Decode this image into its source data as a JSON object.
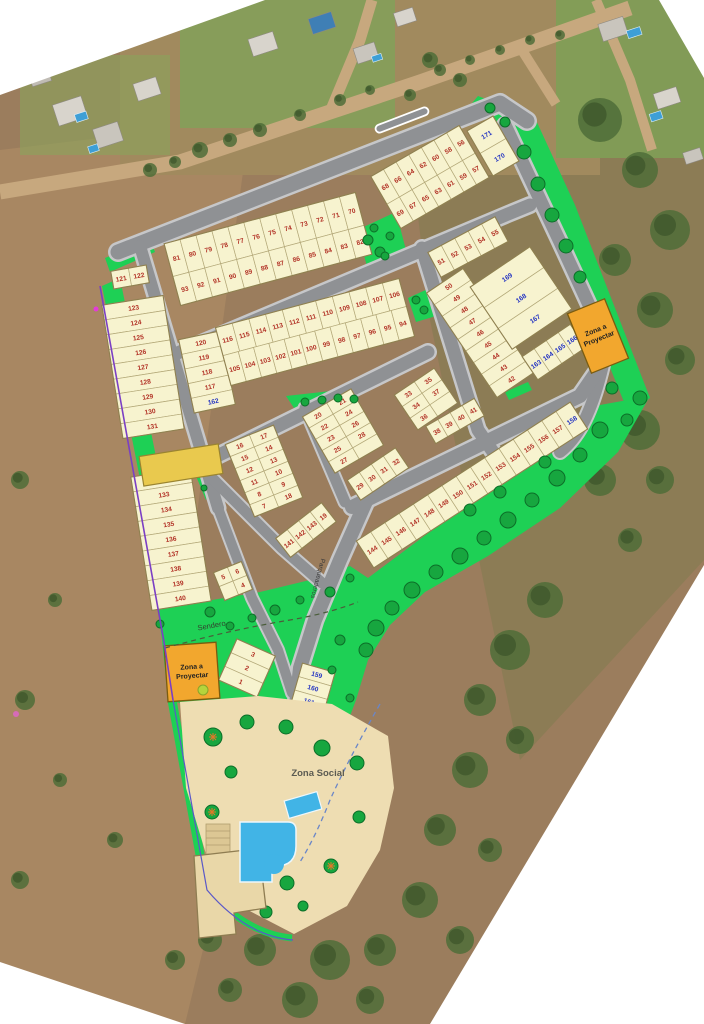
{
  "map": {
    "labels": {
      "zona_a_line1": "Zona a",
      "zona_a_line2": "Proyectar",
      "zona_social": "Zona Social",
      "sendero": "Sendero",
      "parqueaderos": "Parqueaderos"
    },
    "colors": {
      "lot_fill": "#f7f3cf",
      "lot_line": "#b3a878",
      "lot_border": "#8f8050",
      "lot_number_red": "#b23226",
      "lot_number_blue": "#2434c2",
      "road": "#8f9194",
      "curb": "#c6c7c9",
      "green": "#1ed055",
      "tree": "#17a63f",
      "tree_dark": "#0c6e28",
      "orange_zone": "#f2a72e",
      "yellow_zone": "#e9c94e",
      "social_tan": "#eeddb2",
      "pool_blue": "#41b4e6",
      "boundary_purple": "#7b3fc4"
    },
    "blue_lots": [
      158,
      159,
      160,
      161,
      162,
      163,
      164,
      165,
      166,
      167,
      168,
      169,
      170,
      171
    ],
    "strips": [
      {
        "id": "band1",
        "cx": 268,
        "cy": 249,
        "angle": -15,
        "len": 198,
        "rows": [
          {
            "h": 34,
            "nums": [
              81,
              80,
              79,
              78,
              77,
              76,
              75,
              74,
              73,
              72,
              71,
              70
            ]
          },
          {
            "h": 30,
            "nums": [
              93,
              92,
              91,
              90,
              89,
              88,
              87,
              86,
              85,
              84,
              83,
              82
            ]
          }
        ]
      },
      {
        "id": "band1b",
        "cx": 430,
        "cy": 177,
        "angle": -30,
        "len": 102,
        "rows": [
          {
            "h": 32,
            "nums": [
              68,
              66,
              64,
              62,
              60,
              58,
              56
            ]
          },
          {
            "h": 28,
            "nums": [
              69,
              67,
              65,
              63,
              61,
              59,
              57
            ]
          }
        ]
      },
      {
        "id": "end-170",
        "cx": 493,
        "cy": 146,
        "angle": -30,
        "len": 30,
        "rows": [
          {
            "h": 26,
            "nums": [
              171
            ]
          },
          {
            "h": 26,
            "nums": [
              170
            ]
          }
        ]
      },
      {
        "id": "col-117",
        "cx": 207,
        "cy": 372,
        "angle": -12,
        "len": 42,
        "rows": [
          {
            "h": 15,
            "nums": [
              120
            ]
          },
          {
            "h": 15,
            "nums": [
              119
            ]
          },
          {
            "h": 15,
            "nums": [
              118
            ]
          },
          {
            "h": 15,
            "nums": [
              117
            ]
          },
          {
            "h": 15,
            "nums": [
              162
            ]
          }
        ]
      },
      {
        "id": "band2",
        "cx": 315,
        "cy": 332,
        "angle": -15,
        "len": 190,
        "rows": [
          {
            "h": 29,
            "nums": [
              116,
              115,
              114,
              113,
              112,
              111,
              110,
              109,
              108,
              107,
              106
            ]
          },
          {
            "h": 31,
            "nums": [
              105,
              104,
              103,
              102,
              101,
              100,
              99,
              98,
              97,
              96,
              95,
              94
            ]
          }
        ]
      },
      {
        "id": "col-42-50",
        "cx": 480,
        "cy": 333,
        "angle": -34,
        "len": 44,
        "rows": [
          {
            "h": 14,
            "nums": [
              50
            ]
          },
          {
            "h": 14,
            "nums": [
              49
            ]
          },
          {
            "h": 14,
            "nums": [
              48
            ]
          },
          {
            "h": 14,
            "nums": [
              47
            ]
          },
          {
            "h": 14,
            "nums": [
              46
            ]
          },
          {
            "h": 14,
            "nums": [
              45
            ]
          },
          {
            "h": 14,
            "nums": [
              44
            ]
          },
          {
            "h": 14,
            "nums": [
              43
            ]
          },
          {
            "h": 14,
            "nums": [
              42
            ]
          }
        ]
      },
      {
        "id": "big-167",
        "cx": 521,
        "cy": 298,
        "angle": -34,
        "len": 72,
        "rows": [
          {
            "h": 25,
            "nums": [
              169
            ]
          },
          {
            "h": 25,
            "nums": [
              168
            ]
          },
          {
            "h": 25,
            "nums": [
              167
            ]
          }
        ]
      },
      {
        "id": "row-163",
        "cx": 554,
        "cy": 352,
        "angle": -34,
        "len": 58,
        "rows": [
          {
            "h": 28,
            "nums": [
              163,
              164,
              165,
              166
            ]
          }
        ]
      },
      {
        "id": "blk-33",
        "cx": 426,
        "cy": 399,
        "angle": -34,
        "len": 48,
        "rows": [
          {
            "h": 14,
            "nums": [
              33,
              35
            ]
          },
          {
            "h": 14,
            "nums": [
              34,
              37
            ]
          },
          {
            "h": 14,
            "nums": [
              36,
              null
            ]
          }
        ]
      },
      {
        "id": "blk-38",
        "cx": 455,
        "cy": 421,
        "angle": -30,
        "len": 56,
        "rows": [
          {
            "h": 20,
            "nums": [
              38,
              39,
              40,
              41
            ]
          }
        ]
      },
      {
        "id": "blk-7-18",
        "cx": 264,
        "cy": 471,
        "angle": -22,
        "len": 52,
        "rows": [
          {
            "h": 13,
            "nums": [
              16,
              17
            ]
          },
          {
            "h": 13,
            "nums": [
              15,
              14
            ]
          },
          {
            "h": 13,
            "nums": [
              12,
              13
            ]
          },
          {
            "h": 13,
            "nums": [
              11,
              10
            ]
          },
          {
            "h": 13,
            "nums": [
              8,
              9
            ]
          },
          {
            "h": 13,
            "nums": [
              7,
              18
            ]
          }
        ]
      },
      {
        "id": "blk-141",
        "cx": 306,
        "cy": 530,
        "angle": -38,
        "len": 58,
        "rows": [
          {
            "h": 24,
            "nums": [
              141,
              142,
              143,
              19
            ]
          }
        ]
      },
      {
        "id": "blk-20-28",
        "cx": 343,
        "cy": 431,
        "angle": -30,
        "len": 56,
        "rows": [
          {
            "h": 13,
            "nums": [
              20,
              21
            ]
          },
          {
            "h": 13,
            "nums": [
              22,
              24
            ]
          },
          {
            "h": 13,
            "nums": [
              23,
              26
            ]
          },
          {
            "h": 13,
            "nums": [
              25,
              28
            ]
          },
          {
            "h": 13,
            "nums": [
              27,
              null
            ]
          }
        ]
      },
      {
        "id": "blk-29-32",
        "cx": 378,
        "cy": 474,
        "angle": -34,
        "len": 58,
        "rows": [
          {
            "h": 24,
            "nums": [
              29,
              30,
              31,
              32
            ]
          }
        ]
      },
      {
        "id": "strip-144-158",
        "cx": 472,
        "cy": 485,
        "angle": -33,
        "len": 255,
        "rows": [
          {
            "h": 32,
            "nums": [
              144,
              145,
              146,
              147,
              148,
              149,
              150,
              151,
              152,
              153,
              154,
              155,
              156,
              157,
              158
            ]
          }
        ]
      },
      {
        "id": "col-121",
        "cx": 130,
        "cy": 277,
        "angle": -10,
        "len": 36,
        "rows": [
          {
            "h": 18,
            "nums": [
              121,
              122
            ]
          }
        ]
      },
      {
        "id": "col-123-131",
        "cx": 143,
        "cy": 367,
        "angle": -9,
        "len": 62,
        "rows": [
          {
            "h": 15,
            "nums": [
              123
            ]
          },
          {
            "h": 15,
            "nums": [
              124
            ]
          },
          {
            "h": 15,
            "nums": [
              125
            ]
          },
          {
            "h": 15,
            "nums": [
              126
            ]
          },
          {
            "h": 15,
            "nums": [
              127
            ]
          },
          {
            "h": 15,
            "nums": [
              128
            ]
          },
          {
            "h": 15,
            "nums": [
              129
            ]
          },
          {
            "h": 15,
            "nums": [
              130
            ]
          },
          {
            "h": 15,
            "nums": [
              131
            ]
          }
        ]
      },
      {
        "id": "col-132-140",
        "cx": 171,
        "cy": 539,
        "angle": -9,
        "len": 60,
        "rows": [
          {
            "h": 15,
            "nums": [
              132
            ]
          },
          {
            "h": 15,
            "nums": [
              133
            ]
          },
          {
            "h": 15,
            "nums": [
              134
            ]
          },
          {
            "h": 15,
            "nums": [
              135
            ]
          },
          {
            "h": 15,
            "nums": [
              136
            ]
          },
          {
            "h": 15,
            "nums": [
              137
            ]
          },
          {
            "h": 15,
            "nums": [
              138
            ]
          },
          {
            "h": 15,
            "nums": [
              139
            ]
          },
          {
            "h": 15,
            "nums": [
              140
            ]
          }
        ]
      },
      {
        "id": "blk-4-6",
        "cx": 233,
        "cy": 581,
        "angle": -22,
        "len": 30,
        "rows": [
          {
            "h": 15,
            "nums": [
              5,
              6
            ]
          },
          {
            "h": 15,
            "nums": [
              null,
              4
            ]
          }
        ]
      },
      {
        "id": "blk-1-3",
        "cx": 247,
        "cy": 668,
        "angle": 24,
        "len": 42,
        "rows": [
          {
            "h": 15,
            "nums": [
              3
            ]
          },
          {
            "h": 15,
            "nums": [
              2
            ]
          },
          {
            "h": 15,
            "nums": [
              1
            ]
          }
        ]
      },
      {
        "id": "blk-159-161",
        "cx": 313,
        "cy": 688,
        "angle": 16,
        "len": 34,
        "rows": [
          {
            "h": 14,
            "nums": [
              159
            ]
          },
          {
            "h": 14,
            "nums": [
              160
            ]
          },
          {
            "h": 14,
            "nums": [
              161
            ]
          }
        ]
      },
      {
        "id": "col-51-55",
        "cx": 468,
        "cy": 247,
        "angle": -28,
        "len": 76,
        "rows": [
          {
            "h": 28,
            "nums": [
              51,
              52,
              53,
              54,
              55
            ]
          }
        ]
      }
    ]
  }
}
